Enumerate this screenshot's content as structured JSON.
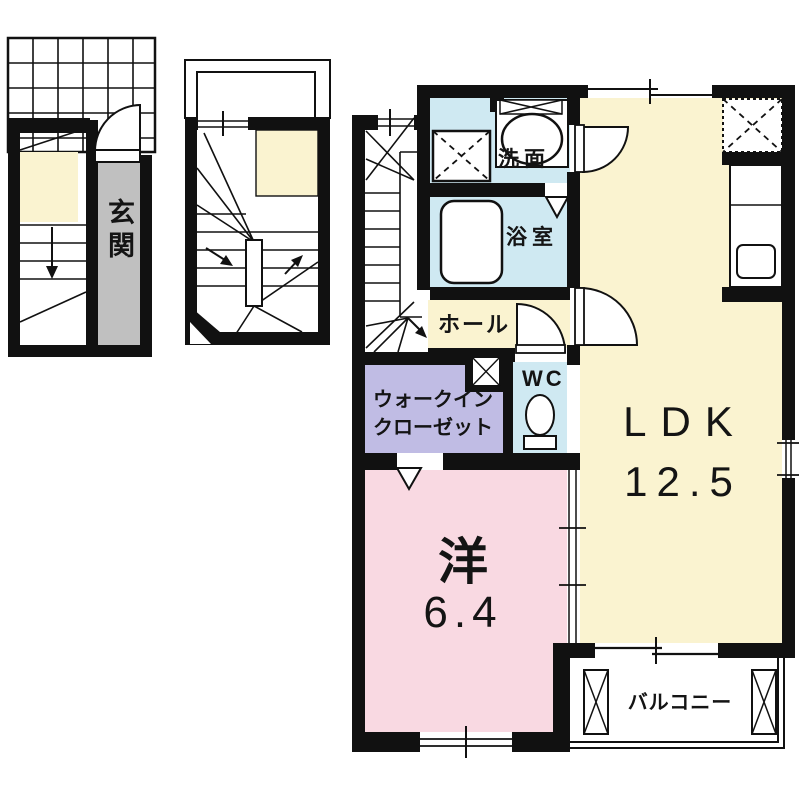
{
  "document": {
    "type": "apartment-floor-plan",
    "floors_shown": 3
  },
  "plan": {
    "floor1": {
      "genkan": "玄関"
    },
    "floor3": {
      "senmen": "洗面",
      "yokushitsu": "浴室",
      "hall": "ホール",
      "wc": "WC",
      "wic1": "ウォークイン",
      "wic2": "クローゼット",
      "ldk": "LDK",
      "ldk_area": "12.5",
      "western": "洋",
      "western_area": "6.4",
      "balcony": "バルコニー"
    }
  },
  "rooms": [
    {
      "name": "entrance",
      "label": "玄関",
      "floor_color": "#c0c0c0"
    },
    {
      "name": "washroom",
      "label": "洗面",
      "floor_color": "#cfe9f2"
    },
    {
      "name": "bathroom",
      "label": "浴室",
      "floor_color": "#cfe9f2"
    },
    {
      "name": "hall",
      "label": "ホール",
      "floor_color": "#faf3d0"
    },
    {
      "name": "toilet",
      "label": "WC",
      "floor_color": "#cfe9f2"
    },
    {
      "name": "walk-in-closet",
      "label": "ウォークインクローゼット",
      "floor_color": "#c0bce4"
    },
    {
      "name": "living-dining-kitchen",
      "label": "LDK",
      "area_tatami": "12.5",
      "floor_color": "#faf3d0"
    },
    {
      "name": "western-room",
      "label": "洋",
      "area_tatami": "6.4",
      "floor_color": "#f9d9e2"
    },
    {
      "name": "balcony",
      "label": "バルコニー",
      "floor_color": "#ffffff"
    }
  ],
  "colors": {
    "wall": "#111111",
    "cream": "#faf3d0",
    "blue": "#cfe9f2",
    "purple": "#c0bce4",
    "pink": "#f9d9e2",
    "gray": "#c0c0c0",
    "background": "#ffffff"
  }
}
